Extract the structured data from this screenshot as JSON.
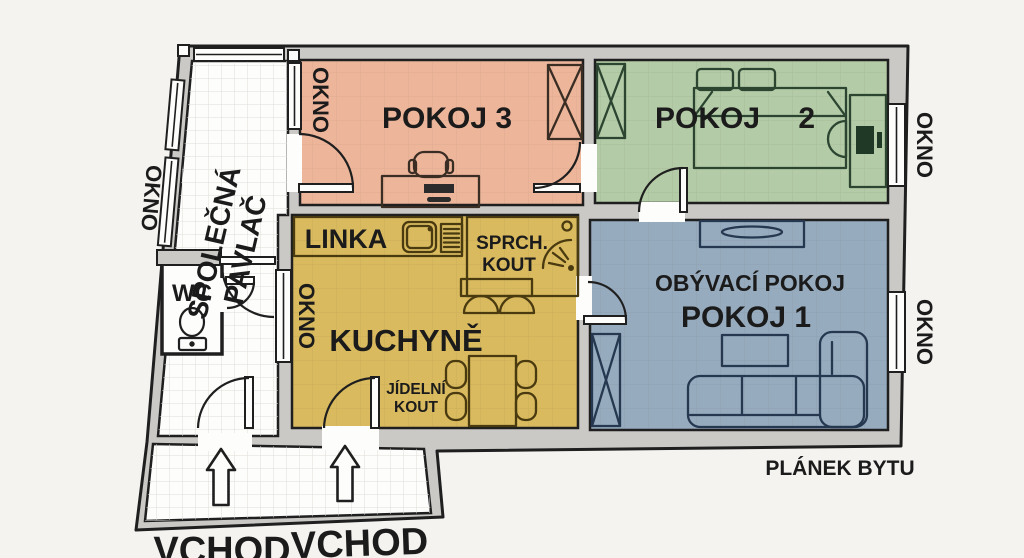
{
  "plan": {
    "caption": "PLÁNEK BYTU"
  },
  "rooms": {
    "pokoj3": {
      "name": "POKOJ 3"
    },
    "pokoj2": {
      "name": "POKOJ 2"
    },
    "obyvaci": {
      "subtitle": "OBÝVACÍ POKOJ",
      "name": "POKOJ 1"
    },
    "kuchyne": {
      "name": "KUCHYNĚ"
    },
    "pavlac": {
      "name_line1": "SPOLEČNÁ",
      "name_line2": "PAVLAČ"
    },
    "wc": {
      "name": "WC"
    }
  },
  "zones": {
    "linka": {
      "name": "LINKA"
    },
    "sprch": {
      "line1": "SPRCH.",
      "line2": "KOUT"
    },
    "jidelni": {
      "line1": "JÍDELNÍ",
      "line2": "KOUT"
    }
  },
  "labels": {
    "window": "OKNO",
    "entrance": "VCHOD"
  },
  "colors": {
    "background": "#f5f3f0",
    "wall": "#cac9c6",
    "outline": "#1f1f1f",
    "floor": "#fdfdfc",
    "pokoj3": "#edb69b",
    "pokoj2": "#b3cba6",
    "kuchyne": "#d9ba5f",
    "obyvaci": "#97abbe",
    "text": "#1b1b1b"
  }
}
